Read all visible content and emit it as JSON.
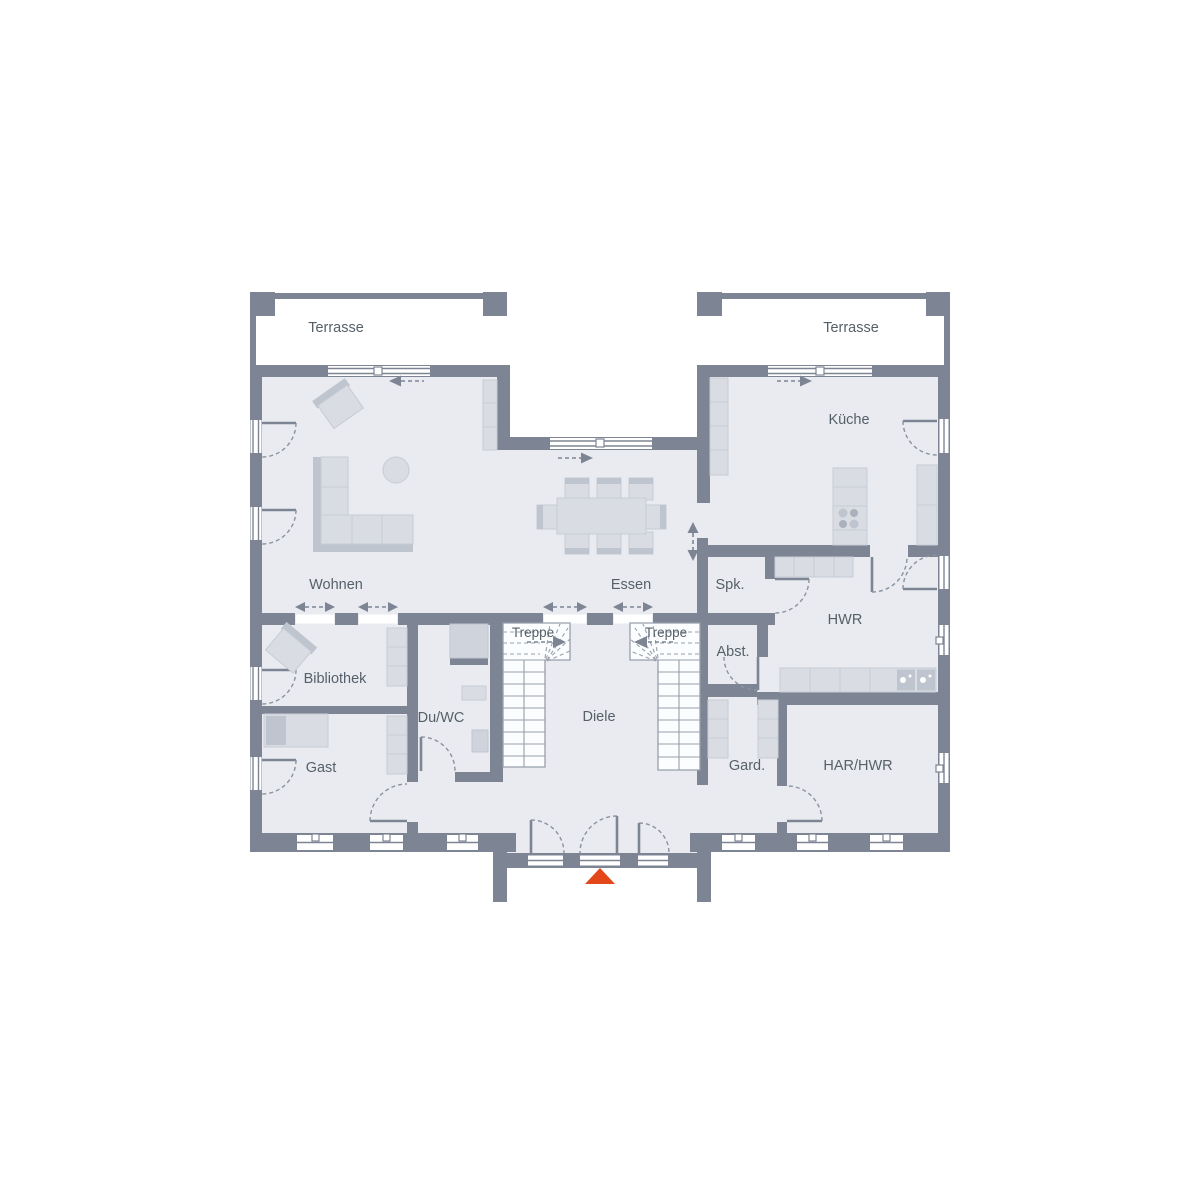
{
  "labels": {
    "terrace_left": "Terrasse",
    "terrace_right": "Terrasse",
    "living": "Wohnen",
    "dining": "Essen",
    "kitchen": "Küche",
    "pantry": "Spk.",
    "utility_room": "HWR",
    "stairs_left": "Treppe",
    "stairs_right": "Treppe",
    "hallway": "Diele",
    "storage": "Abst.",
    "library": "Bibliothek",
    "shower_wc": "Du/WC",
    "guest": "Gast",
    "wardrobe": "Gard.",
    "tech_room": "HAR/HWR"
  },
  "markers": {
    "entrance": "triangle-up"
  },
  "colors": {
    "wall": "#7d8594",
    "floor": "#e9ebf0",
    "white": "#ffffff",
    "furniture": "#d9dce3",
    "furniture_dark": "#bfc5cf",
    "furniture_line": "#c6cbd4",
    "stair_line": "#98a0ac",
    "arc": "#8a93a0",
    "text": "#566069",
    "accent": "#e2481a"
  }
}
